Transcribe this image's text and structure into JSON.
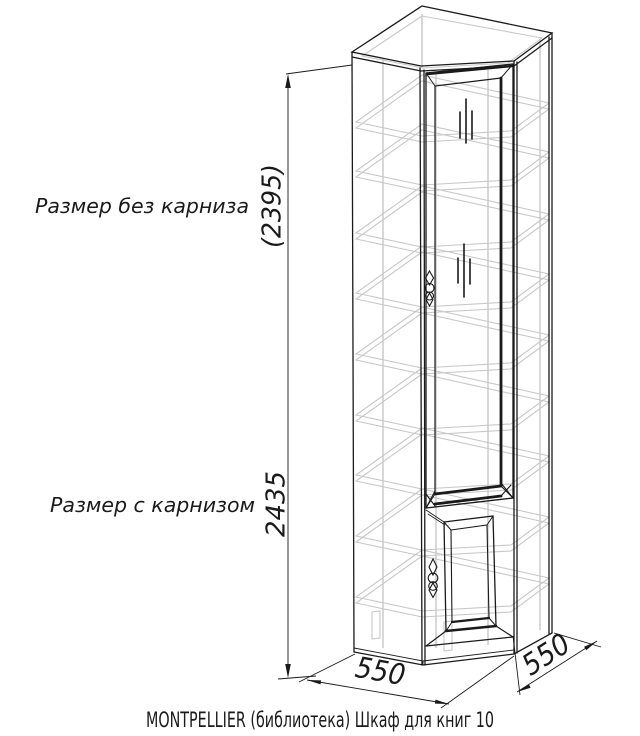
{
  "drawing": {
    "caption": "MONTPELLIER (библиотека) Шкаф для книг 10",
    "dimensions": {
      "height_no_cornice_label": "Размер без карниза",
      "height_no_cornice_value": "(2395)",
      "height_with_cornice_label": "Размер с карнизом",
      "height_with_cornice_value": "2435",
      "width_value": "550",
      "depth_value": "550"
    },
    "colors": {
      "line": "#1a1a1a",
      "hidden_line": "#c8c8c8",
      "background": "#ffffff"
    }
  }
}
